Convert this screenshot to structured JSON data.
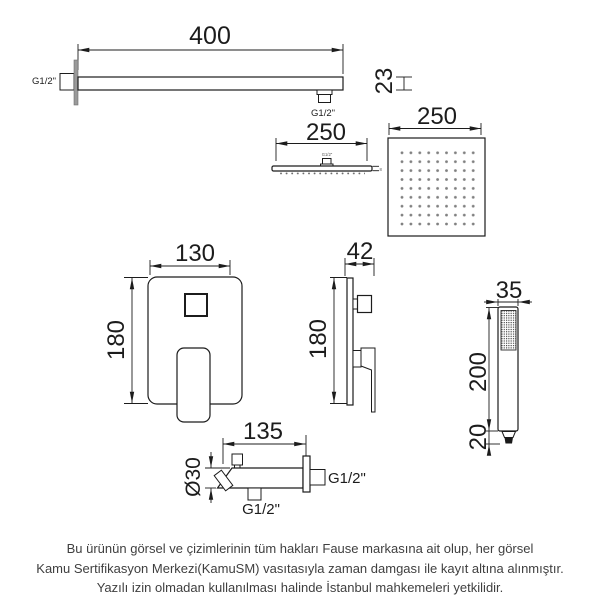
{
  "colors": {
    "line": "#1c1c1c",
    "text": "#1c1c1c",
    "footer_text": "#3f3f3f",
    "nozzle_dot": "#808080",
    "background": "#ffffff"
  },
  "arm": {
    "length": "400",
    "tube_height": "23",
    "wall_thread": "G1/2\"",
    "outlet_thread": "G1/2\""
  },
  "head_side": {
    "width": "250",
    "top_thread": "G1/2\"",
    "thickness": "8"
  },
  "head_top": {
    "width": "250"
  },
  "mixer_front": {
    "width": "130",
    "height": "180"
  },
  "mixer_side": {
    "depth": "42",
    "height": "180"
  },
  "hand_shower": {
    "width": "35",
    "body_length": "200",
    "connector_length": "20"
  },
  "outlet": {
    "length": "135",
    "diameter": "Ø30",
    "bottom_thread": "G1/2\"",
    "wall_thread": "G1/2\""
  },
  "footer": {
    "line1": "Bu ürünün görsel ve çizimlerinin tüm hakları Fause markasına ait olup, her görsel",
    "line2": "Kamu Sertifikasyon Merkezi(KamuSM) vasıtasıyla zaman damgası ile kayıt altına alınmıştır.",
    "line3": "Yazılı izin olmadan kullanılması halinde İstanbul mahkemeleri yetkilidir."
  }
}
